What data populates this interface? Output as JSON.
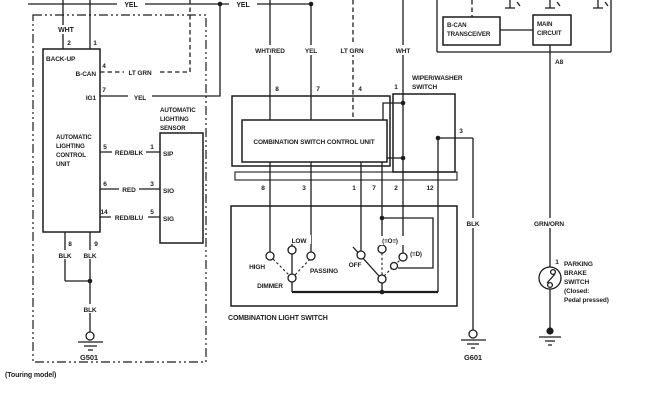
{
  "top_bus": {
    "yel_1": "YEL",
    "yel_2": "YEL"
  },
  "touring_section": {
    "note": "(Touring model)",
    "wht_label": "WHT",
    "pin_2": "2",
    "pin_1": "1",
    "backup_label": "BACK-UP",
    "bcan_label": "B-CAN",
    "bcan_pin": "4",
    "bcan_wire": "LT GRN",
    "ig1_label": "IG1",
    "ig1_pin": "7",
    "ig1_wire": "YEL",
    "unit_lines": [
      "AUTOMATIC",
      "LIGHTING",
      "CONTROL",
      "UNIT"
    ],
    "rows": [
      {
        "pin": "5",
        "wire": "RED/BLK",
        "sensor_pin": "1",
        "sensor_label": "SIP"
      },
      {
        "pin": "6",
        "wire": "RED",
        "sensor_pin": "3",
        "sensor_label": "SIO"
      },
      {
        "pin": "14",
        "wire": "RED/BLU",
        "sensor_pin": "5",
        "sensor_label": "SIG"
      }
    ],
    "sensor_title_lines": [
      "AUTOMATIC",
      "LIGHTING",
      "SENSOR"
    ],
    "pin_8": "8",
    "pin_9": "9",
    "blk_1": "BLK",
    "blk_2": "BLK",
    "blk_3": "BLK",
    "ground_label": "G501"
  },
  "center": {
    "whtred": "WHT/RED",
    "yel": "YEL",
    "ltgrn": "LT GRN",
    "wht": "WHT",
    "pin_8": "8",
    "pin_7": "7",
    "pin_4": "4",
    "cscu_label": "COMBINATION SWITCH CONTROL UNIT",
    "strip_pins": [
      "8",
      "3",
      "1",
      "7",
      "2",
      "12"
    ]
  },
  "wiper_switch": {
    "title_lines": [
      "WIPER/WASHER",
      "SWITCH"
    ],
    "pin_1": "1",
    "pin_3": "3"
  },
  "light_switch": {
    "title": "COMBINATION LIGHT SWITCH",
    "high": "HIGH",
    "low": "LOW",
    "passing": "PASSING",
    "dimmer": "DIMMER",
    "off": "OFF",
    "position_lamp": "(≡O≡)",
    "headlamp": "(≡D)"
  },
  "right_section": {
    "transceiver_lines": [
      "B-CAN",
      "TRANSCEIVER"
    ],
    "main_lines": [
      "MAIN",
      "CIRCUIT"
    ],
    "pin_a8": "A8",
    "grnorn": "GRN/ORN",
    "blk": "BLK",
    "ground_label": "G601",
    "parking_pin": "1",
    "parking_lines": [
      "PARKING",
      "BRAKE",
      "SWITCH",
      "(Closed:",
      "Pedal pressed)"
    ]
  }
}
